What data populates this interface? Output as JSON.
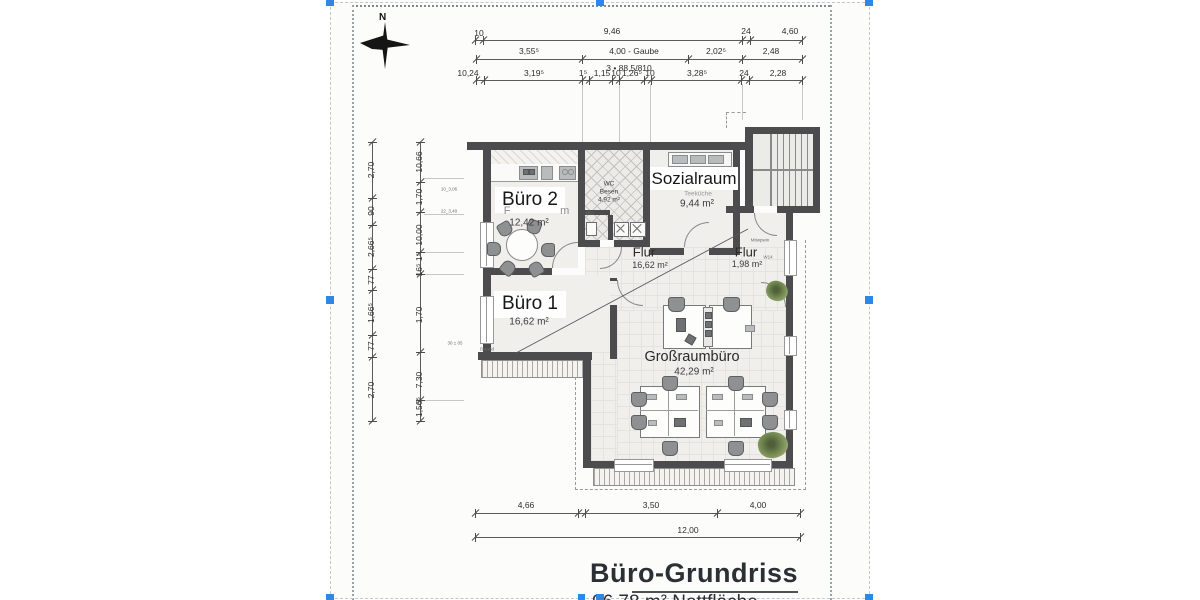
{
  "north": {
    "label": "N"
  },
  "title_block": {
    "title": "Büro-Grundriss",
    "subtitle": "96,78 m² Nettfläche"
  },
  "rooms": {
    "buero2": {
      "name": "Büro 2",
      "area": "12,42 m²",
      "ghost": "F            m"
    },
    "buero1": {
      "name": "Büro 1",
      "area": "16,62 m²"
    },
    "sozialraum": {
      "name": "Sozialraum",
      "area": "9,44 m²",
      "ghost": "Teeküche"
    },
    "wc": {
      "line1": "WC",
      "line2": "Besen",
      "line3": "4,92 m²"
    },
    "flur1": {
      "name": "Flur",
      "area": "16,62 m²"
    },
    "flur2": {
      "name": "Flur",
      "area": "1,98 m²"
    },
    "grossraum": {
      "name": "Großraumbüro",
      "area": "42,29 m²"
    }
  },
  "dimensions": {
    "groups": [
      {
        "id": "top-row-1",
        "o": "h",
        "x1": 475,
        "x2": 802,
        "y": 40,
        "ticks": [
          475,
          483,
          742,
          750,
          802
        ],
        "labels": [
          {
            "t": "10",
            "x": 479,
            "y": 33
          },
          {
            "t": "9,46",
            "x": 612,
            "y": 31
          },
          {
            "t": "24",
            "x": 746,
            "y": 31
          },
          {
            "t": "4,60",
            "x": 790,
            "y": 31
          }
        ]
      },
      {
        "id": "top-row-2",
        "o": "h",
        "x1": 476,
        "x2": 802,
        "y": 59,
        "ticks": [
          476,
          582,
          688,
          742,
          802
        ],
        "labels": [
          {
            "t": "3,55⁵",
            "x": 529,
            "y": 51
          },
          {
            "t": "4,00 - Gaube",
            "x": 634,
            "y": 51
          },
          {
            "t": "2,02⁵",
            "x": 716,
            "y": 51
          },
          {
            "t": "2,48",
            "x": 771,
            "y": 51
          },
          {
            "t": "3 • 88,5/810",
            "x": 629,
            "y": 68
          }
        ]
      },
      {
        "id": "top-row-3",
        "o": "h",
        "x1": 476,
        "x2": 802,
        "y": 80,
        "ticks": [
          476,
          484,
          582,
          589,
          612,
          619,
          644,
          651,
          741,
          749,
          802
        ],
        "labels": [
          {
            "t": "10,24",
            "x": 468,
            "y": 73
          },
          {
            "t": "3,19⁵",
            "x": 534,
            "y": 73
          },
          {
            "t": "1⁵",
            "x": 583,
            "y": 73
          },
          {
            "t": "1,15",
            "x": 602,
            "y": 73
          },
          {
            "t": "10",
            "x": 616,
            "y": 73
          },
          {
            "t": "1,26⁵",
            "x": 632,
            "y": 73
          },
          {
            "t": "10",
            "x": 650,
            "y": 73
          },
          {
            "t": "3,28⁵",
            "x": 697,
            "y": 73
          },
          {
            "t": "24",
            "x": 744,
            "y": 73
          },
          {
            "t": "2,28",
            "x": 778,
            "y": 73
          }
        ]
      },
      {
        "id": "left-outer",
        "o": "v",
        "y1": 142,
        "y2": 421,
        "x": 372,
        "ticks": [
          142,
          198,
          225,
          269,
          290,
          335,
          357,
          421
        ],
        "labels": [
          {
            "t": "2,70",
            "x": 371,
            "y": 170,
            "rot": -90
          },
          {
            "t": "90",
            "x": 371,
            "y": 211,
            "rot": -90
          },
          {
            "t": "2,66⁵",
            "x": 371,
            "y": 247,
            "rot": -90
          },
          {
            "t": "77",
            "x": 371,
            "y": 280,
            "rot": -90
          },
          {
            "t": "1,66⁵",
            "x": 371,
            "y": 313,
            "rot": -90
          },
          {
            "t": "77",
            "x": 371,
            "y": 346,
            "rot": -90
          },
          {
            "t": "2,70",
            "x": 371,
            "y": 390,
            "rot": -90
          }
        ]
      },
      {
        "id": "left-inner",
        "o": "v",
        "y1": 142,
        "y2": 421,
        "x": 420,
        "ticks": [
          142,
          182,
          212,
          252,
          274,
          352,
          400,
          421
        ],
        "labels": [
          {
            "t": "10,66",
            "x": 419,
            "y": 162,
            "rot": -90
          },
          {
            "t": "1,70",
            "x": 419,
            "y": 197,
            "rot": -90
          },
          {
            "t": "10,00",
            "x": 419,
            "y": 235,
            "rot": -90
          },
          {
            "t": "1⁵",
            "x": 419,
            "y": 257,
            "rot": -90
          },
          {
            "t": "16⁵",
            "x": 419,
            "y": 270,
            "rot": -90
          },
          {
            "t": "1,70",
            "x": 419,
            "y": 315,
            "rot": -90
          },
          {
            "t": "7,30",
            "x": 419,
            "y": 380,
            "rot": -90
          },
          {
            "t": "1,56⁵",
            "x": 419,
            "y": 407,
            "rot": -90
          }
        ]
      },
      {
        "id": "bottom-row-1",
        "o": "h",
        "x1": 475,
        "x2": 800,
        "y": 513,
        "ticks": [
          475,
          578,
          585,
          717,
          800
        ],
        "labels": [
          {
            "t": "4,66",
            "x": 526,
            "y": 505
          },
          {
            "t": "3,50",
            "x": 651,
            "y": 505
          },
          {
            "t": "4,00",
            "x": 758,
            "y": 505
          }
        ]
      },
      {
        "id": "bottom-row-2",
        "o": "h",
        "x1": 475,
        "x2": 800,
        "y": 537,
        "ticks": [
          475,
          800
        ],
        "labels": [
          {
            "t": "12,00",
            "x": 688,
            "y": 530
          }
        ]
      }
    ]
  },
  "annotations": [
    {
      "t": "10_3,06",
      "x": 449,
      "y": 189
    },
    {
      "t": "22_3,40",
      "x": 449,
      "y": 211
    },
    {
      "t": "30 ± 05",
      "x": 455,
      "y": 343
    },
    {
      "t": "Bstand",
      "x": 487,
      "y": 349
    },
    {
      "t": "M01",
      "x": 590,
      "y": 213
    },
    {
      "t": "Mitwpwin",
      "x": 760,
      "y": 240
    },
    {
      "t": "W14",
      "x": 768,
      "y": 257
    }
  ],
  "colors": {
    "accent_blue": "#2e86e5",
    "wall": "#4c4c4e",
    "floor": "#f0efec",
    "plant_green": "#7c9158",
    "title_text": "#2b3036"
  }
}
